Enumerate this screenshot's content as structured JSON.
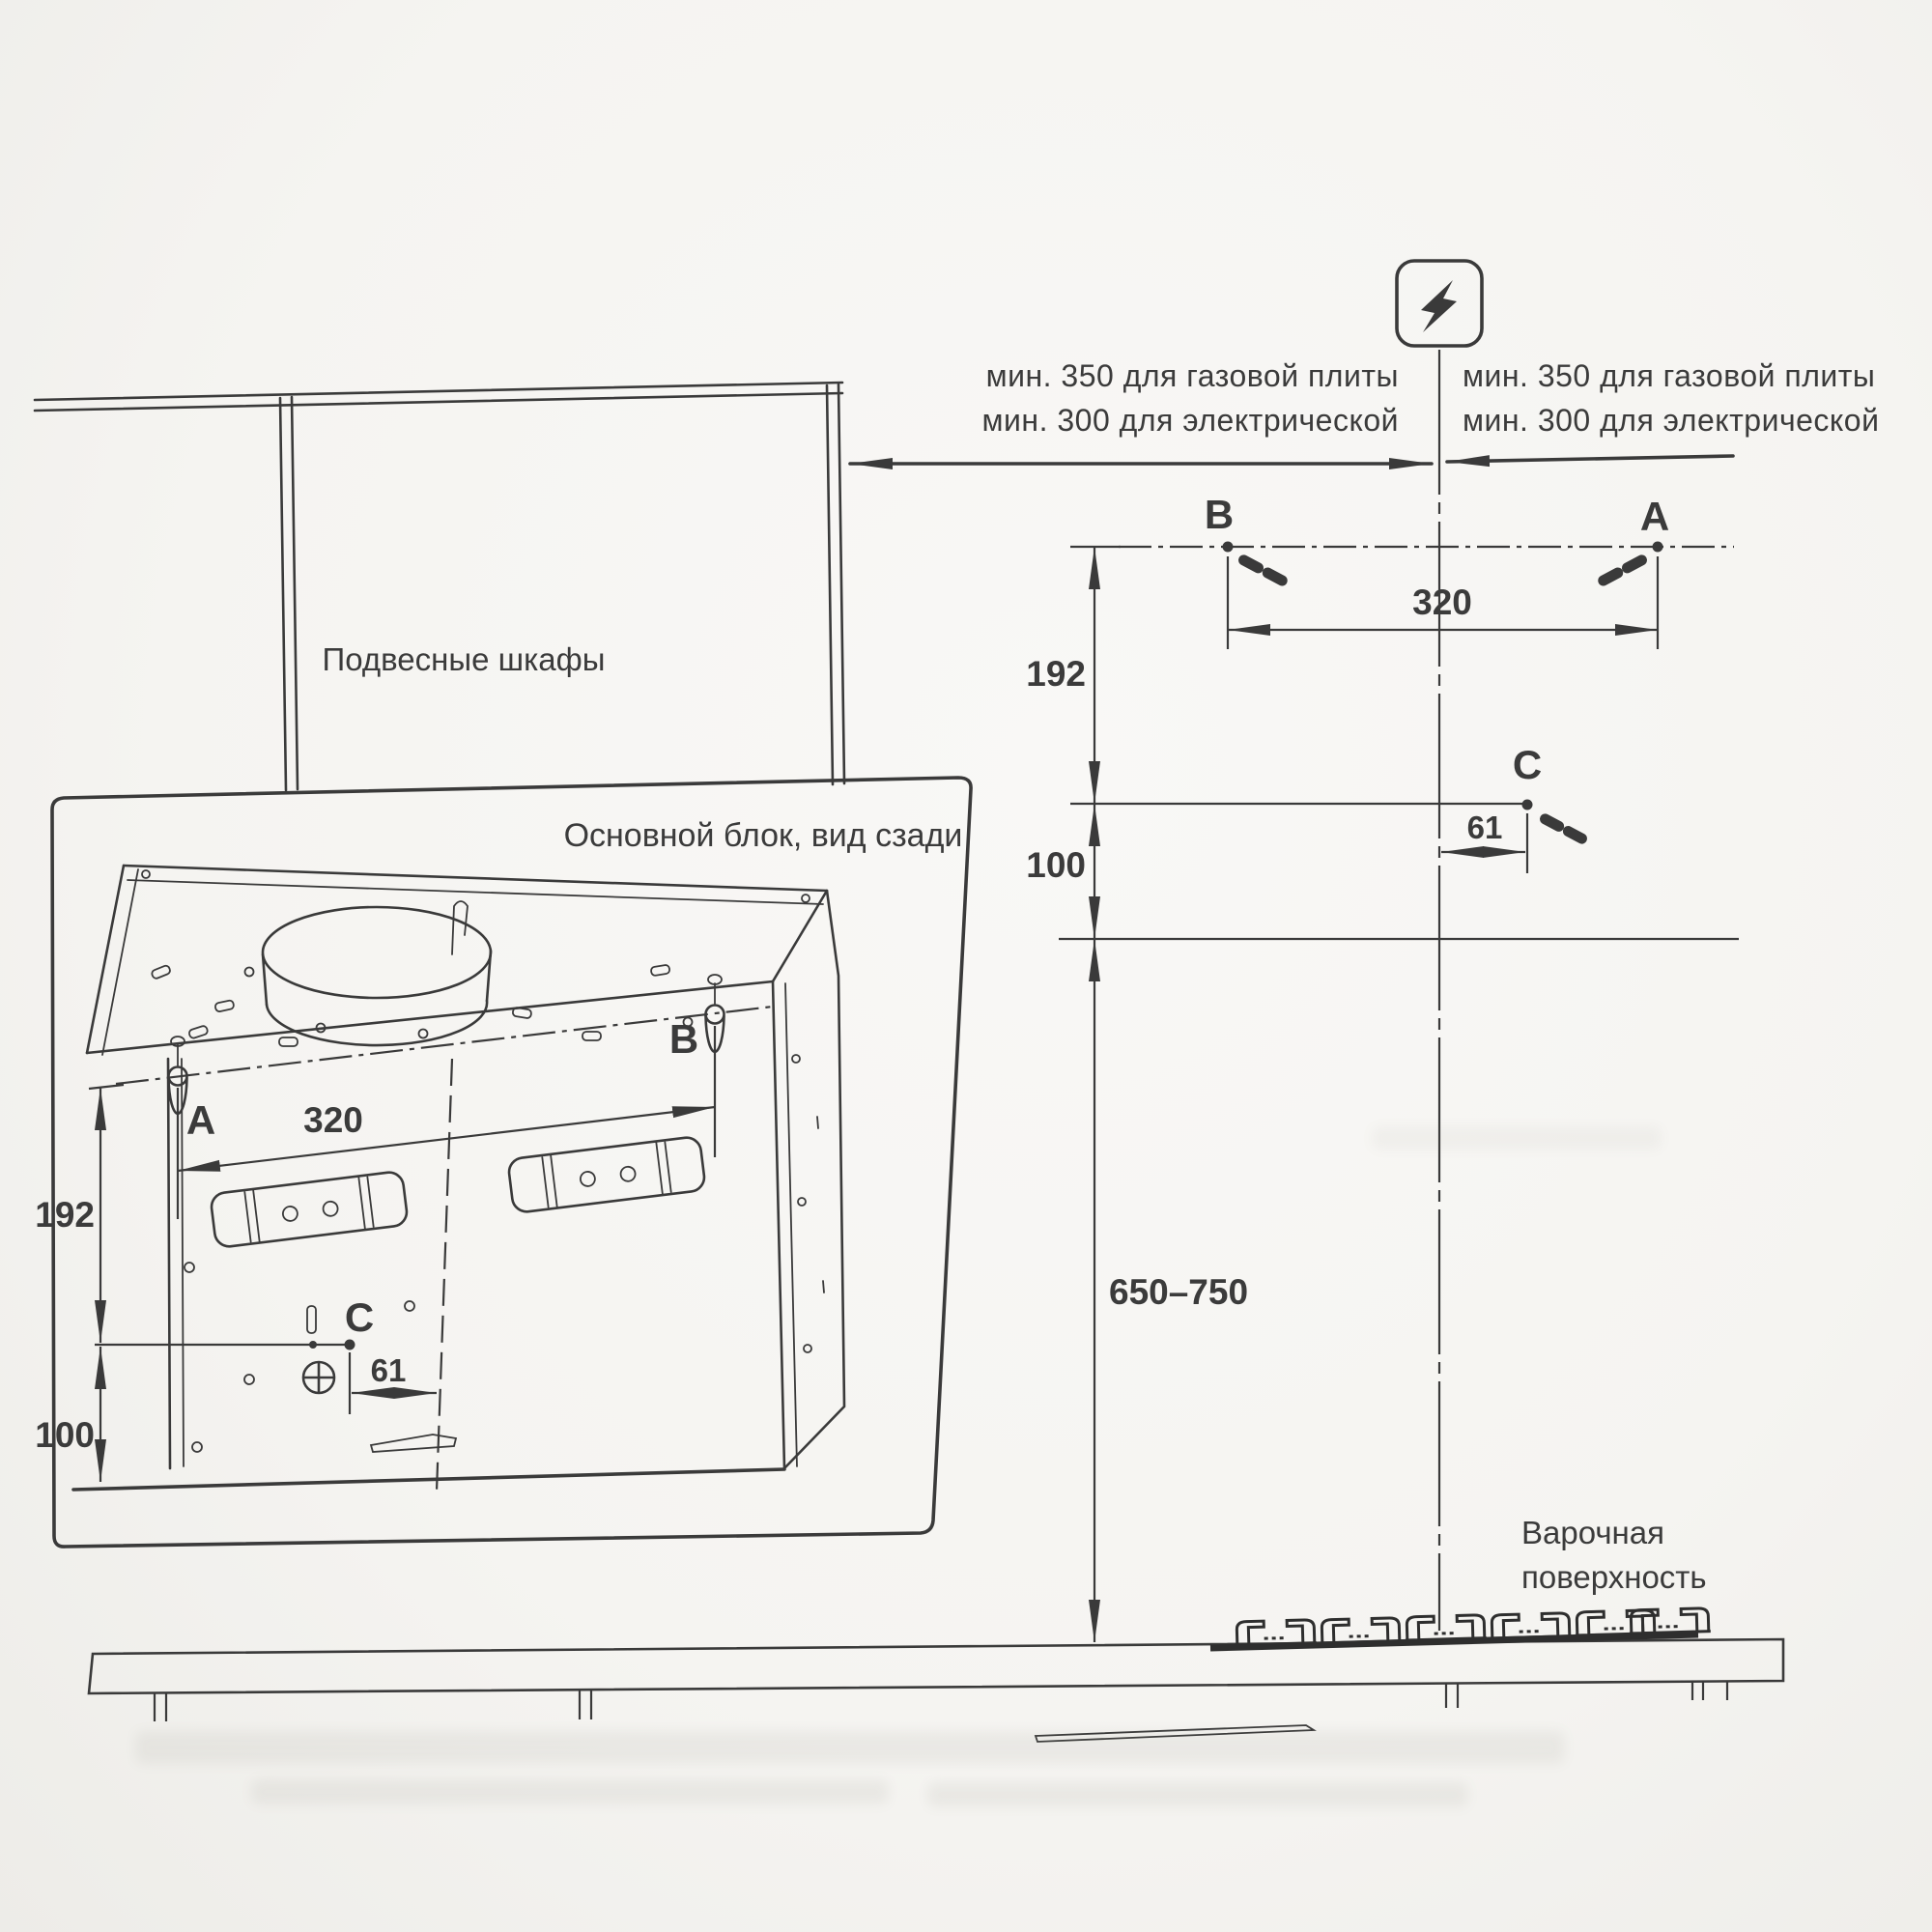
{
  "page": {
    "kind": "installation-diagram",
    "line_color": "#3a3a3a",
    "paper_color": "#f5f4f1"
  },
  "power_icon": {
    "name": "lightning-icon"
  },
  "clearance_left": {
    "line1": "мин. 350 для газовой плиты",
    "line2": "мин. 300 для электрической"
  },
  "clearance_right": {
    "line1": "мин. 350 для газовой плиты",
    "line2": "мин. 300 для электрической"
  },
  "cabinets": {
    "label": "Подвесные шкафы"
  },
  "inset": {
    "title": "Основной блок, вид сзади",
    "label_a": "A",
    "label_b": "B",
    "label_c": "C",
    "dim_ab": "320",
    "dim_height": "192",
    "dim_bottom": "100",
    "dim_c_offset": "61"
  },
  "wall": {
    "label_a": "A",
    "label_b": "B",
    "label_c": "C",
    "dim_ab": "320",
    "dim_height": "192",
    "dim_bottom": "100",
    "dim_c_offset": "61",
    "dim_hood_to_hob": "650–750"
  },
  "cooktop": {
    "label_line1": "Варочная",
    "label_line2": "поверхность"
  }
}
